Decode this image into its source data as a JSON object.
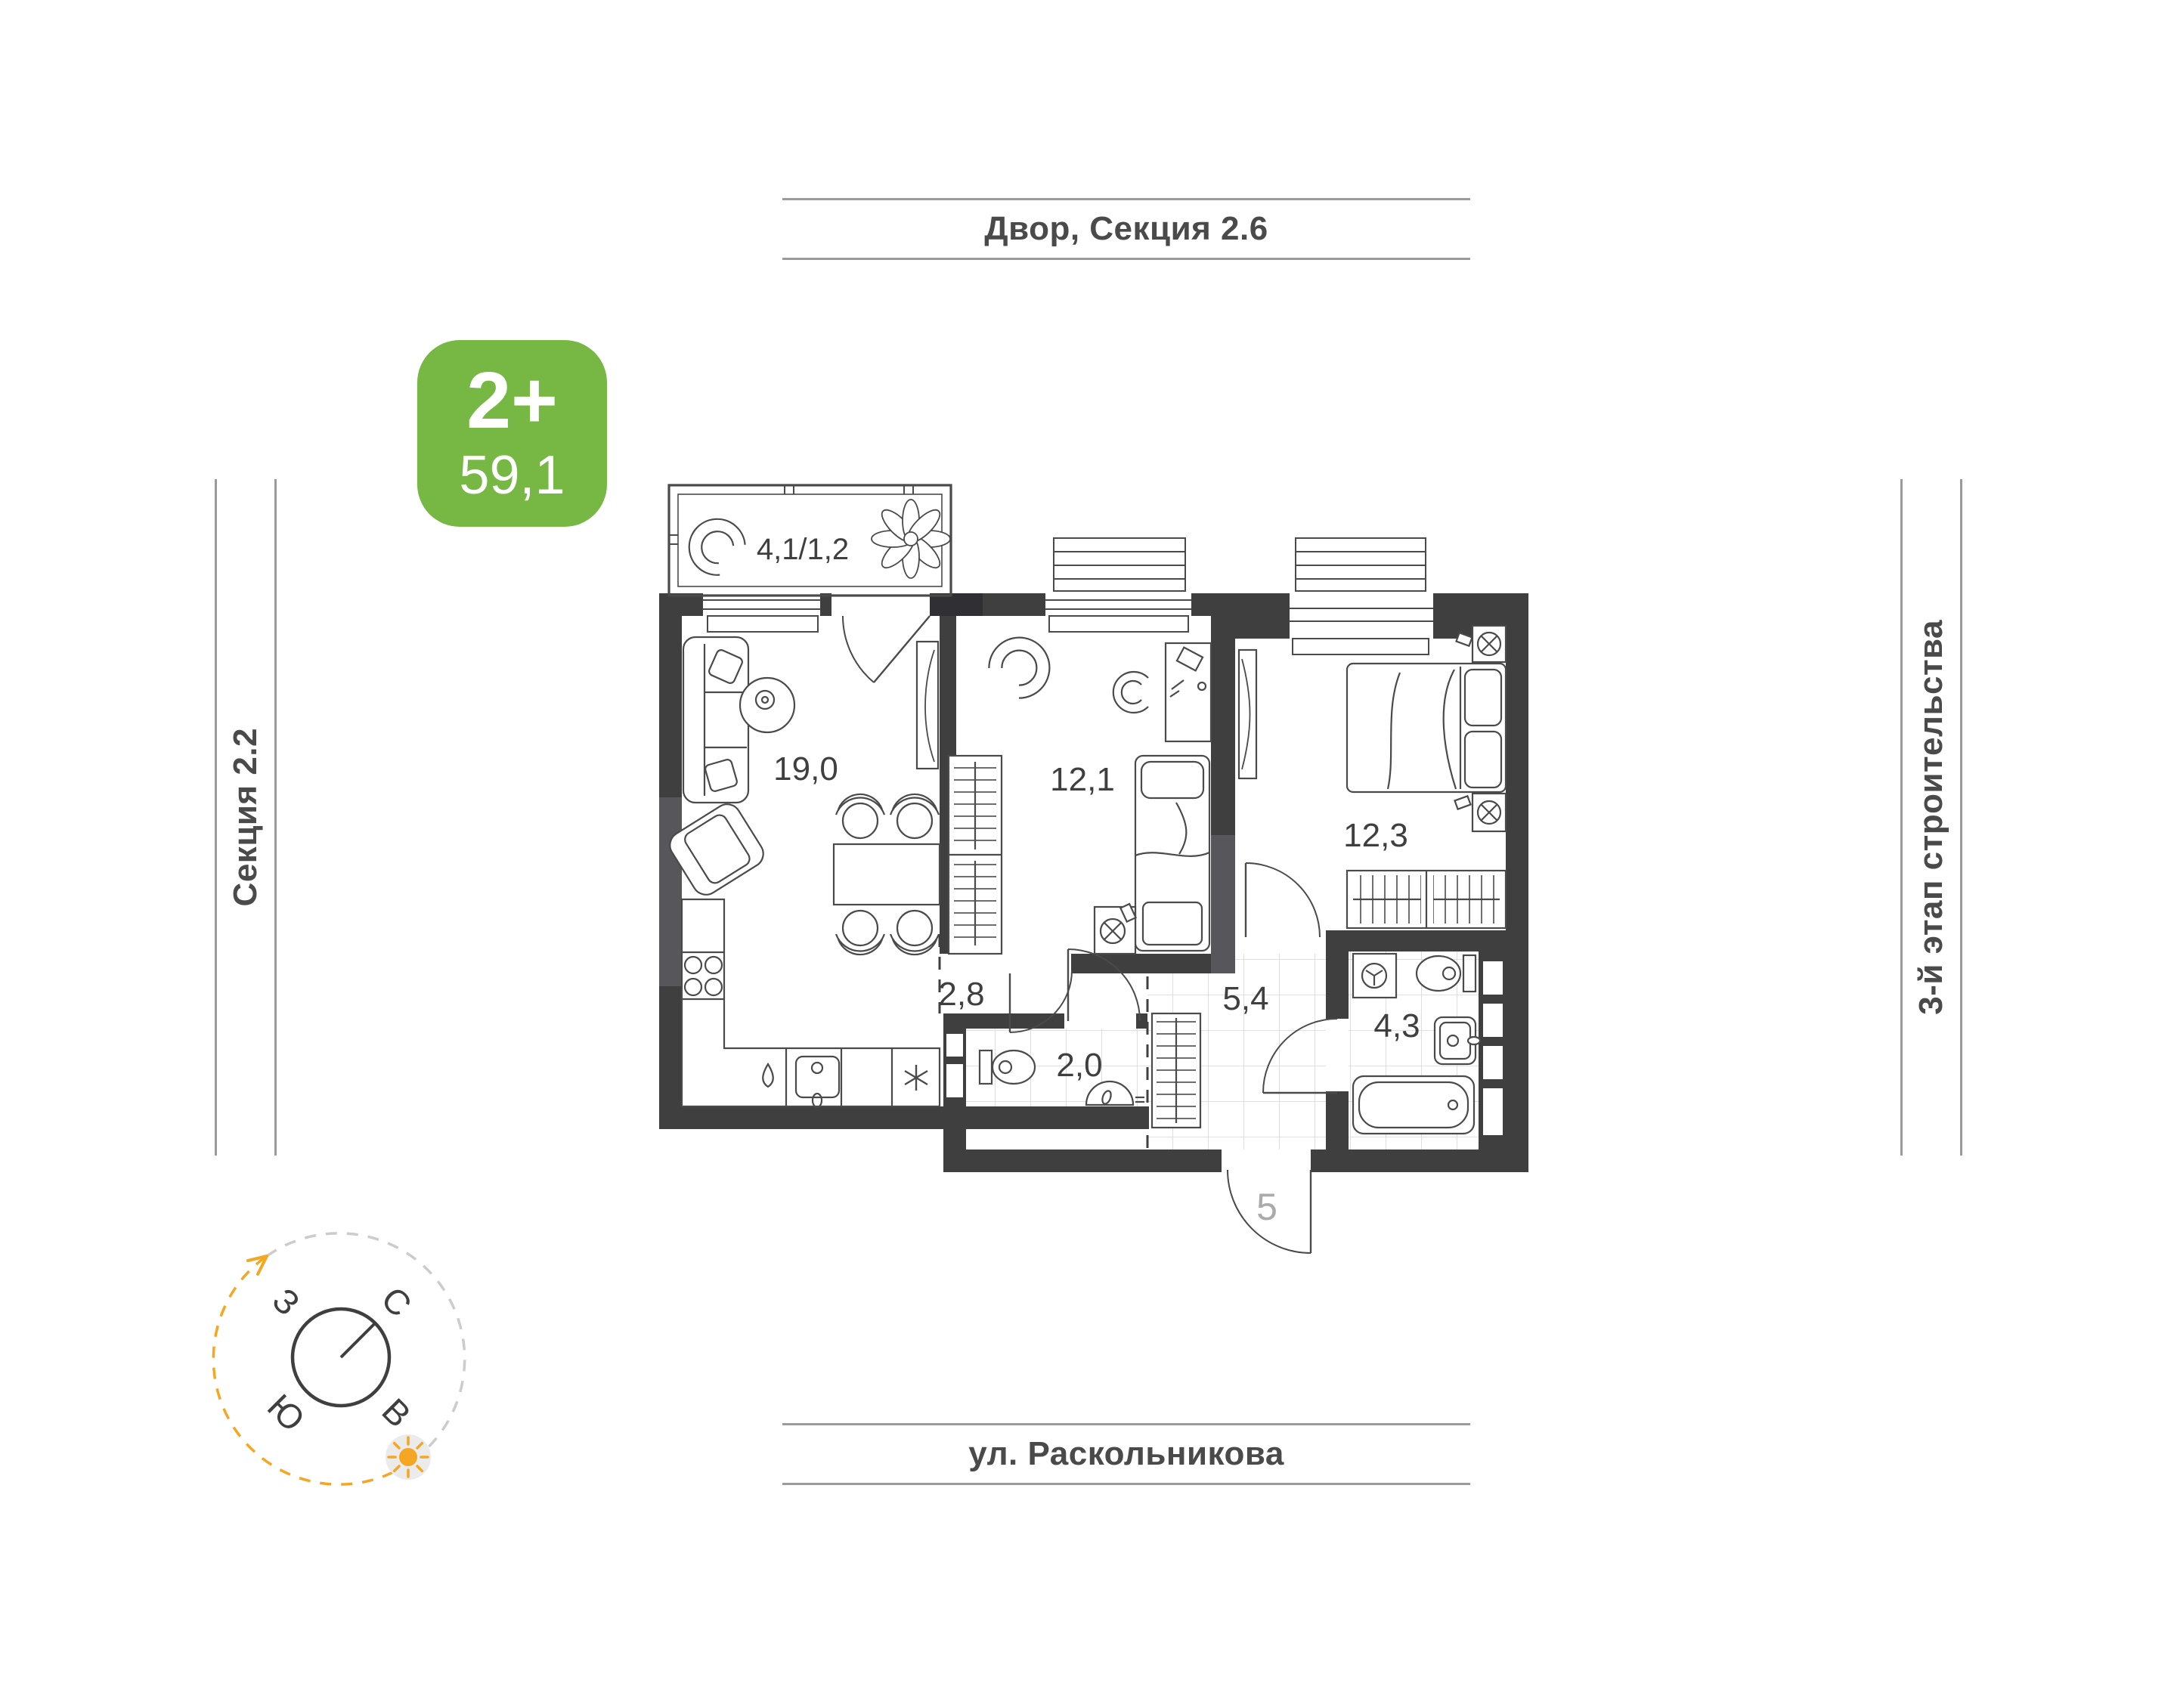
{
  "frame_labels": {
    "top": "Двор, Секция 2.6",
    "bottom": "ул. Раскольникова",
    "left": "Секция 2.2",
    "right": "3-й этап строительства"
  },
  "badge": {
    "rooms": "2+",
    "area": "59,1"
  },
  "plan": {
    "apartment_number": "5",
    "rooms": [
      {
        "id": "balcony",
        "area": "4,1/1,2"
      },
      {
        "id": "living-kitchen",
        "area": "19,0"
      },
      {
        "id": "bedroom-1",
        "area": "12,1"
      },
      {
        "id": "bedroom-2",
        "area": "12,3"
      },
      {
        "id": "hall",
        "area": "2,8"
      },
      {
        "id": "corridor",
        "area": "5,4"
      },
      {
        "id": "wc",
        "area": "2,0"
      },
      {
        "id": "bathroom",
        "area": "4,3"
      }
    ]
  },
  "compass": {
    "north": "С",
    "south": "Ю",
    "west": "З",
    "east": "В"
  },
  "colors": {
    "walls": "#3f3f3f",
    "accent_green": "#76b843",
    "accent_orange": "#f5a623",
    "frame_line_gray": "#9b9b9b",
    "tile_gray": "#d6d6d6",
    "label_gray": "#4a4a4a",
    "muted_gray": "#ababab"
  }
}
